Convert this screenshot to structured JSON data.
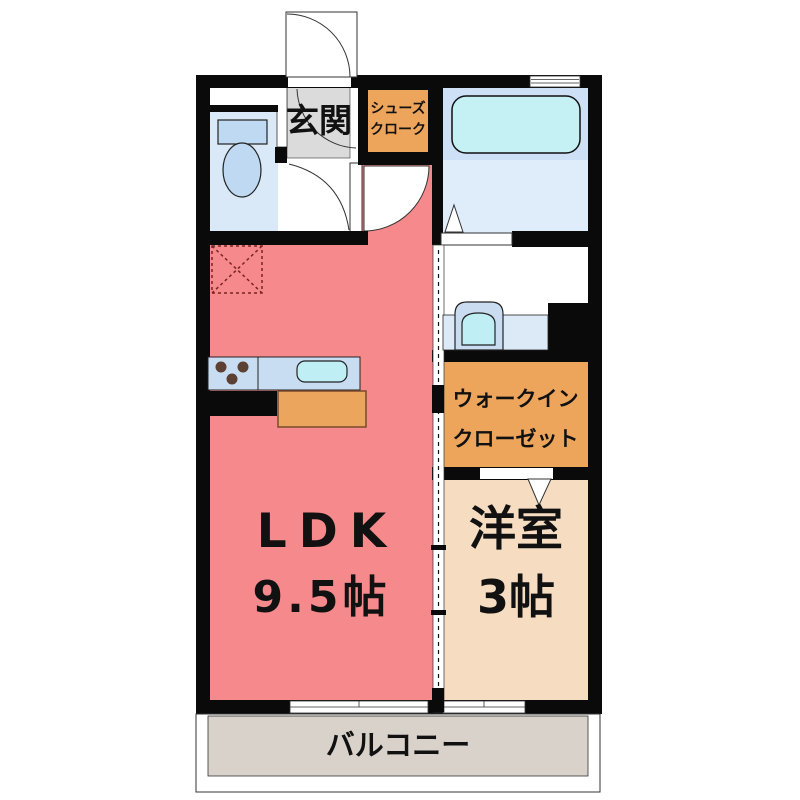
{
  "rooms": {
    "ldk": {
      "label": "LDK",
      "area": "9.5帖"
    },
    "western_room": {
      "label": "洋室",
      "area": "3帖"
    },
    "entrance": {
      "label": "玄関"
    },
    "shoes_closet": {
      "label_line1": "シューズ",
      "label_line2": "クローク"
    },
    "walk_in_closet": {
      "label_line1": "ウォークイン",
      "label_line2": "クローゼット"
    },
    "balcony": {
      "label": "バルコニー"
    }
  },
  "colors": {
    "wall": "#0a0a0a",
    "ldk": "#F5898B",
    "western_room": "#F6DCC0",
    "closet_orange": "#EDA55C",
    "entrance_gray": "#DBDBDB",
    "toilet_room": "#D9E9F8",
    "bathroom_upper": "#CEE0F5",
    "bathroom_lower": "#DFECFA",
    "bathtub": "#C5F0F4",
    "kitchen_counter": "#C9DDF2",
    "vanity_counter": "#DCEAF8",
    "sink_cyan": "#BFEFF4",
    "toilet_fixture": "#BFD9F2",
    "cabinet_orange": "#EBA55C",
    "balcony_floor": "#D9D2CA",
    "fridge_dash": "#7A2424",
    "burner_brown": "#5C4033"
  },
  "fixtures": {
    "entrance_door": "entrance swing door",
    "toilet": "toilet",
    "bathtub": "bathtub",
    "washbasin": "washbasin vanity",
    "kitchen_counter": "kitchen counter with stove and sink",
    "refrigerator_space": "refrigerator space (dashed)",
    "sliding_partition": "sliding door partition",
    "balcony_windows": "sliding windows to balcony"
  }
}
